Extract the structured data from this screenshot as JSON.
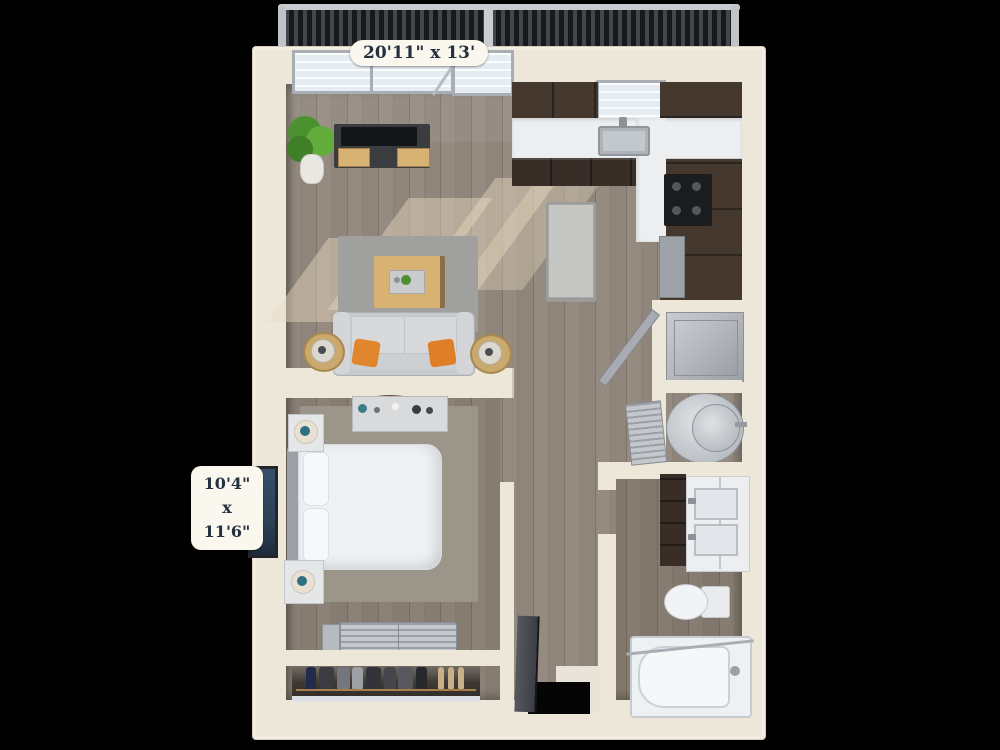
{
  "labels": {
    "living_area_dimensions": "20'11\" x 13'",
    "bedroom_width": "10'4\"",
    "dimension_separator": "x",
    "bedroom_length": "11'6\""
  },
  "colors": {
    "background": "#000000",
    "wall": "#EDE7D9",
    "wall_shade": "#D8D1BF",
    "floor_wood": "#8E857B",
    "rug_living": "#A0A19F",
    "rug_bedroom": "#9C9589",
    "cabinet_espresso": "#44382F",
    "cabinet_espresso_dark": "#382E27",
    "countertop": "#ECEEF0",
    "island_gray": "#C6C7C5",
    "stainless_steel": "#9DA2A8",
    "sofa_gray": "#C8CBCE",
    "pillow_orange": "#E0862C",
    "wood_accent": "#D8B272",
    "linen_white": "#EEF0F3",
    "lamp_teal": "#2F6F80",
    "plant_green": "#54A033",
    "railing_dark": "#1A1C1F",
    "window_pane": "#E5ECF2",
    "window_frame": "#A9AEB5",
    "label_background": "#FAF7EE",
    "label_text": "#243040",
    "art_navy": "#2C4356",
    "door_slab": "#3B3E43"
  },
  "elements": [
    "balcony-railing",
    "living-room",
    "kitchen",
    "bedroom",
    "bathroom",
    "reach-in-closet",
    "entry",
    "sofa",
    "orange-throw-pillows",
    "coffee-table",
    "tv-console",
    "potted-plant",
    "side-tables",
    "kitchen-island",
    "kitchen-sink",
    "cooktop",
    "refrigerator",
    "washer-dryer",
    "water-heater",
    "bed",
    "nightstands",
    "table-lamps",
    "dresser",
    "wall-art",
    "louvered-closet-doors",
    "hanging-clothes",
    "bathroom-vanity",
    "double-sinks",
    "toilet",
    "bathtub",
    "entry-door"
  ]
}
